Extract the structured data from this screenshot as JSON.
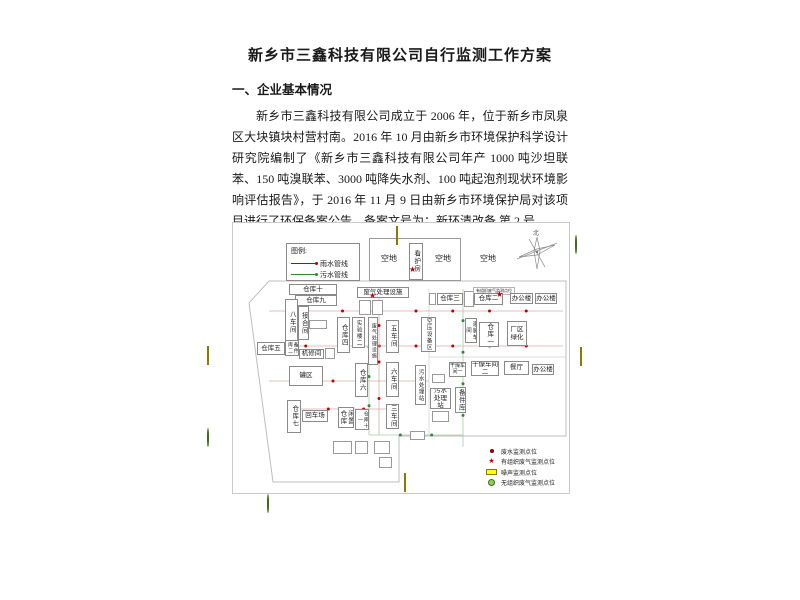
{
  "page": {
    "title": "新乡市三鑫科技有限公司自行监测工作方案",
    "section1_heading": "一、企业基本情况",
    "paragraph": "新乡市三鑫科技有限公司成立于 2006 年，位于新乡市凤泉区大块镇块村营村南。2016 年 10 月由新乡市环境保护科学设计研究院编制了《新乡市三鑫科技有限公司年产 1000 吨沙坦联苯、150 吨溴联苯、3000 吨降失水剂、100 吨起泡剂现状环境影响评估报告》，于 2016 年 11 月 9 日由新乡市环境保护局对该项目进行了环保备案公告，备案文号为：新环清改备 第 2 号。",
    "section2_heading": "二、监测点位及示意图"
  },
  "legend_pipes": {
    "title": "图例:",
    "items": [
      {
        "label": "雨水管线",
        "color": "#c00000"
      },
      {
        "label": "污水管线",
        "color": "#2e8b2e"
      }
    ]
  },
  "legend_points": {
    "items": [
      {
        "label": "废水监测点位",
        "type": "red-dot",
        "color": "#c00000"
      },
      {
        "label": "有组织废气监测点位",
        "type": "red-star",
        "color": "#c00000"
      },
      {
        "label": "噪声监测点位",
        "type": "yellow-rect",
        "color": "#ffff00"
      },
      {
        "label": "无组织废气监测点位",
        "type": "green-circle",
        "color": "#92d050"
      }
    ]
  },
  "diagram": {
    "compass_label": "北",
    "buildings": [
      {
        "label": "空地",
        "x": 141,
        "y": 28,
        "w": 30,
        "h": 16,
        "v": false,
        "noborder": true
      },
      {
        "label": "空地",
        "x": 197,
        "y": 28,
        "w": 26,
        "h": 16,
        "v": false,
        "noborder": true
      },
      {
        "label": "空地",
        "x": 242,
        "y": 28,
        "w": 26,
        "h": 16,
        "v": false,
        "noborder": true
      },
      {
        "label": "看护房",
        "x": 176,
        "y": 20,
        "w": 14,
        "h": 37,
        "v": true
      },
      {
        "label": "仓库十",
        "x": 56,
        "y": 61,
        "w": 48,
        "h": 11,
        "v": false
      },
      {
        "label": "仓库九",
        "x": 62,
        "y": 72,
        "w": 42,
        "h": 11,
        "v": false
      },
      {
        "label": "八车间",
        "x": 52,
        "y": 76,
        "w": 13,
        "h": 46,
        "v": true
      },
      {
        "label": "接合间",
        "x": 65,
        "y": 83,
        "w": 11,
        "h": 34,
        "v": true
      },
      {
        "label": "仓库五",
        "x": 24,
        "y": 119,
        "w": 28,
        "h": 13,
        "v": false
      },
      {
        "label": "备件库二",
        "x": 52,
        "y": 117,
        "w": 14,
        "h": 16,
        "v": true,
        "fs": 5
      },
      {
        "label": "机修间",
        "x": 66,
        "y": 126,
        "w": 25,
        "h": 10,
        "v": false
      },
      {
        "label": "罐区",
        "x": 56,
        "y": 143,
        "w": 34,
        "h": 20,
        "v": false
      },
      {
        "label": "仓库七",
        "x": 54,
        "y": 177,
        "w": 14,
        "h": 33,
        "v": true
      },
      {
        "label": "回车场",
        "x": 69,
        "y": 187,
        "w": 26,
        "h": 12,
        "v": false
      },
      {
        "label": "闲置仓库",
        "x": 105,
        "y": 184,
        "w": 16,
        "h": 21,
        "v": true
      },
      {
        "label": "仓库十一",
        "x": 122,
        "y": 186,
        "w": 14,
        "h": 21,
        "v": true,
        "fs": 5
      },
      {
        "label": "仓库六",
        "x": 122,
        "y": 140,
        "w": 13,
        "h": 34,
        "v": true
      },
      {
        "label": "仓库四",
        "x": 104,
        "y": 94,
        "w": 13,
        "h": 36,
        "v": true
      },
      {
        "label": "实验楼二",
        "x": 119,
        "y": 94,
        "w": 13,
        "h": 31,
        "v": true,
        "fs": 5.5
      },
      {
        "label": "废气处理设施",
        "x": 135,
        "y": 94,
        "w": 10,
        "h": 48,
        "v": true,
        "fs": 5
      },
      {
        "label": "五车间",
        "x": 153,
        "y": 97,
        "w": 13,
        "h": 33,
        "v": true
      },
      {
        "label": "六车间",
        "x": 153,
        "y": 139,
        "w": 13,
        "h": 35,
        "v": true
      },
      {
        "label": "三车间",
        "x": 153,
        "y": 181,
        "w": 13,
        "h": 25,
        "v": true
      },
      {
        "label": "污水处理站",
        "x": 182,
        "y": 142,
        "w": 11,
        "h": 40,
        "v": true,
        "fs": 5.5
      },
      {
        "label": "废气处理设施",
        "x": 124,
        "y": 64,
        "w": 52,
        "h": 11,
        "v": false
      },
      {
        "label": "有组织废气监测点位",
        "x": 240,
        "y": 64,
        "w": 42,
        "h": 8,
        "v": false,
        "tiny": true
      },
      {
        "label": "仓库三",
        "x": 204,
        "y": 70,
        "w": 26,
        "h": 12,
        "v": false
      },
      {
        "label": "仓库二",
        "x": 241,
        "y": 70,
        "w": 29,
        "h": 12,
        "v": false
      },
      {
        "label": "办公楼",
        "x": 277,
        "y": 70,
        "w": 23,
        "h": 11,
        "v": false
      },
      {
        "label": "办公楼",
        "x": 302,
        "y": 70,
        "w": 22,
        "h": 11,
        "v": false
      },
      {
        "label": "空压设备区",
        "x": 188,
        "y": 94,
        "w": 15,
        "h": 35,
        "v": true,
        "fs": 5.5
      },
      {
        "label": "灌装车间",
        "x": 232,
        "y": 95,
        "w": 12,
        "h": 25,
        "v": true,
        "fs": 5.5
      },
      {
        "label": "仓库一",
        "x": 246,
        "y": 99,
        "w": 20,
        "h": 25,
        "v": true
      },
      {
        "label": "厂区绿化",
        "x": 274,
        "y": 98,
        "w": 20,
        "h": 25,
        "v": false
      },
      {
        "label": "干燥车间一",
        "x": 216,
        "y": 139,
        "w": 17,
        "h": 15,
        "v": false,
        "fs": 5
      },
      {
        "label": "干燥车间二",
        "x": 238,
        "y": 138,
        "w": 28,
        "h": 15,
        "v": false
      },
      {
        "label": "餐厅",
        "x": 271,
        "y": 138,
        "w": 25,
        "h": 14,
        "v": false
      },
      {
        "label": "办公楼",
        "x": 299,
        "y": 141,
        "w": 22,
        "h": 11,
        "v": false
      },
      {
        "label": "污水处理站",
        "x": 197,
        "y": 165,
        "w": 21,
        "h": 21,
        "v": false
      },
      {
        "label": "备件库",
        "x": 222,
        "y": 164,
        "w": 11,
        "h": 26,
        "v": true
      }
    ],
    "small_boxes": [
      {
        "x": 136,
        "y": 15,
        "w": 92,
        "h": 43
      },
      {
        "x": 76,
        "y": 97,
        "w": 18,
        "h": 9
      },
      {
        "x": 92,
        "y": 125,
        "w": 10,
        "h": 11
      },
      {
        "x": 126,
        "y": 77,
        "w": 12,
        "h": 15
      },
      {
        "x": 139,
        "y": 77,
        "w": 11,
        "h": 15
      },
      {
        "x": 196,
        "y": 70,
        "w": 7,
        "h": 12
      },
      {
        "x": 231,
        "y": 68,
        "w": 10,
        "h": 16
      },
      {
        "x": 199,
        "y": 151,
        "w": 13,
        "h": 9
      },
      {
        "x": 199,
        "y": 188,
        "w": 17,
        "h": 11
      },
      {
        "x": 177,
        "y": 208,
        "w": 15,
        "h": 9
      },
      {
        "x": 100,
        "y": 218,
        "w": 19,
        "h": 13
      },
      {
        "x": 122,
        "y": 218,
        "w": 13,
        "h": 13
      },
      {
        "x": 141,
        "y": 218,
        "w": 16,
        "h": 13
      },
      {
        "x": 146,
        "y": 234,
        "w": 13,
        "h": 11
      }
    ],
    "markers": [
      {
        "type": "yellow-rect",
        "name": "noise-point",
        "x": 396,
        "y": 227
      },
      {
        "type": "yellow-rect",
        "name": "noise-point",
        "x": 207,
        "y": 347
      },
      {
        "type": "yellow-rect",
        "name": "noise-point",
        "x": 580,
        "y": 348
      },
      {
        "type": "yellow-rect",
        "name": "noise-point",
        "x": 404,
        "y": 474
      },
      {
        "type": "green-circle",
        "name": "fugitive-gas-point",
        "x": 575,
        "y": 236
      },
      {
        "type": "green-circle",
        "name": "fugitive-gas-point",
        "x": 207,
        "y": 429
      },
      {
        "type": "green-circle",
        "name": "fugitive-gas-point",
        "x": 267,
        "y": 495
      },
      {
        "type": "red-star",
        "name": "stack-gas-point",
        "x": 409,
        "y": 259
      },
      {
        "type": "red-star",
        "name": "stack-gas-point",
        "x": 369,
        "y": 285
      },
      {
        "type": "red-star",
        "name": "stack-gas-point",
        "x": 496,
        "y": 284
      }
    ]
  }
}
